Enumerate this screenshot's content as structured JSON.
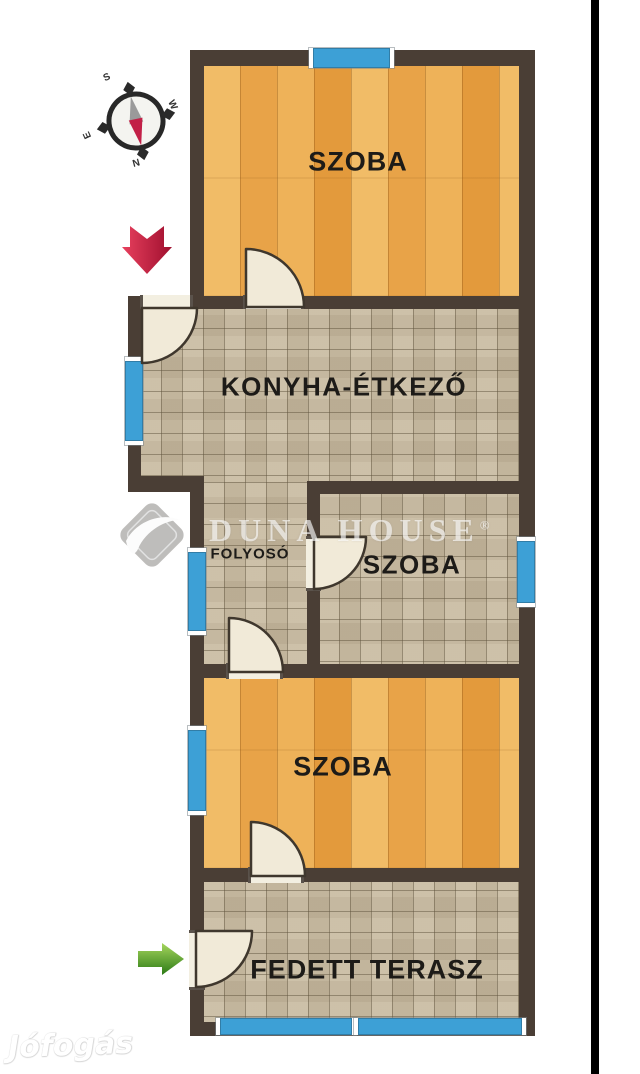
{
  "image": {
    "type": "apartment-floor-plan",
    "language": "hu"
  },
  "rooms": [
    {
      "name": "szoba-top",
      "label": "SZOBA",
      "floor": "wood"
    },
    {
      "name": "konyha-etkezo",
      "label": "KONYHA-ÉTKEZŐ",
      "floor": "tile"
    },
    {
      "name": "folyoso",
      "label": "FOLYOSÓ",
      "floor": "tile"
    },
    {
      "name": "szoba-middle",
      "label": "SZOBA",
      "floor": "tile"
    },
    {
      "name": "szoba-bottom",
      "label": "SZOBA",
      "floor": "wood"
    },
    {
      "name": "fedett-terasz",
      "label": "FEDETT TERASZ",
      "floor": "tile"
    }
  ],
  "compass": {
    "top": "S",
    "right": "W",
    "bottom": "N",
    "left": "E"
  },
  "icons": {
    "compass": "compass-rose-icon",
    "main_entrance": "red-arrow-down-icon",
    "terrace_entrance": "green-arrow-right-icon"
  },
  "watermarks": {
    "agency": "DUNA HOUSE",
    "agency_mark": "®",
    "portal": "Jófogás"
  },
  "colors": {
    "wall": "#4a3e35",
    "wood_floor": "#eaa94c",
    "tile_floor": "#c8baa0",
    "window": "#3da0d6",
    "door_leaf": "#f1ead8",
    "entry_arrow": "#cf2346",
    "terrace_arrow": "#58a629",
    "label_text": "#1d1b18"
  }
}
